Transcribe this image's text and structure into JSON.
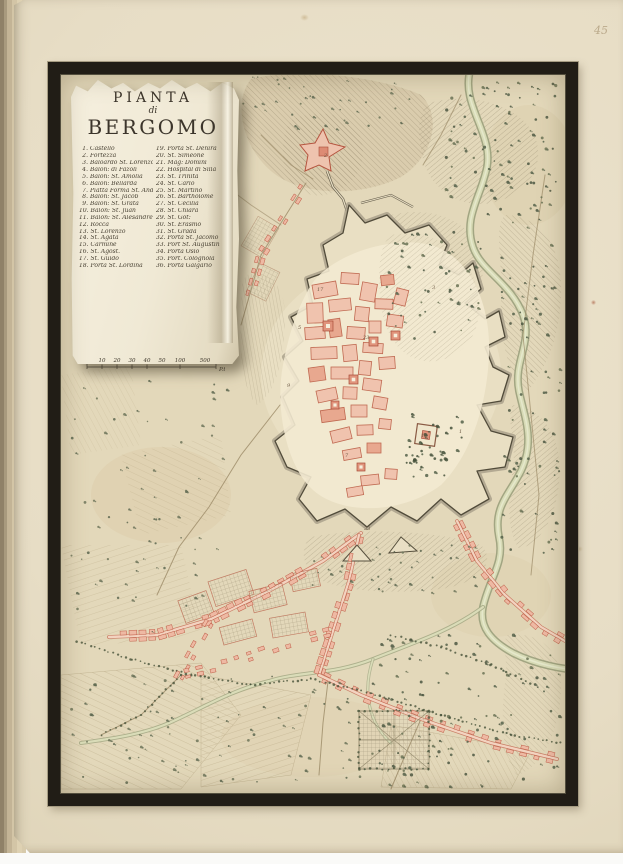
{
  "page": {
    "number": "45"
  },
  "cartouche": {
    "title_line1": "PIANTA",
    "title_line2": "di",
    "title_line3": "BERGOMO",
    "legend_col1": [
      {
        "num": "1.",
        "label": "Castello"
      },
      {
        "num": "2.",
        "label": "Fortezza"
      },
      {
        "num": "3.",
        "label": "Baloardo St. Lorenzo"
      },
      {
        "num": "4.",
        "label": "Balon: di Fazoli"
      },
      {
        "num": "5.",
        "label": "Balon: St. Amolia"
      },
      {
        "num": "6.",
        "label": "Balon: Bellarda"
      },
      {
        "num": "7.",
        "label": "Piatta Forma St. Andrea"
      },
      {
        "num": "8.",
        "label": "Balon: St. Jacob"
      },
      {
        "num": "9.",
        "label": "Balon: St. Grata"
      },
      {
        "num": "10.",
        "label": "Balon: St. Juan"
      },
      {
        "num": "11.",
        "label": "Balon: St. Alesandre"
      },
      {
        "num": "12.",
        "label": "Rocca"
      },
      {
        "num": "13.",
        "label": "St. Lorenzo"
      },
      {
        "num": "14.",
        "label": "St. Agata"
      },
      {
        "num": "15.",
        "label": "Carmine"
      },
      {
        "num": "16.",
        "label": "St. Agost."
      },
      {
        "num": "17.",
        "label": "St. Guido"
      },
      {
        "num": "18.",
        "label": "Porta St. Lordina"
      }
    ],
    "legend_col2": [
      {
        "num": "19.",
        "label": "Porta St. Denira"
      },
      {
        "num": "20.",
        "label": "St. Simeone"
      },
      {
        "num": "21.",
        "label": "Mag: Domini"
      },
      {
        "num": "22.",
        "label": "Hospital di Silla"
      },
      {
        "num": "23.",
        "label": "St. Trinita"
      },
      {
        "num": "24.",
        "label": "St. Carlo"
      },
      {
        "num": "25.",
        "label": "St. Martino"
      },
      {
        "num": "26.",
        "label": "St. Bartholome"
      },
      {
        "num": "27.",
        "label": "St. Cecilia"
      },
      {
        "num": "28.",
        "label": "St. Chiara"
      },
      {
        "num": "29.",
        "label": "St. Got:"
      },
      {
        "num": "30.",
        "label": "St. Erasmo"
      },
      {
        "num": "31.",
        "label": "St. Grada"
      },
      {
        "num": "32.",
        "label": "Porta St. Jacomo"
      },
      {
        "num": "33.",
        "label": "Port St. Augustin"
      },
      {
        "num": "34.",
        "label": "Porta Osio"
      },
      {
        "num": "35.",
        "label": "Port. Colognola"
      },
      {
        "num": "36.",
        "label": "Porta Galgario"
      }
    ],
    "scale": {
      "ticks": [
        {
          "v": "10"
        },
        {
          "v": "20"
        },
        {
          "v": "30"
        },
        {
          "v": "40"
        },
        {
          "v": "50"
        }
      ],
      "mid": "100",
      "end": "500",
      "unit": "P.ti Rg. B."
    }
  },
  "map": {
    "numbers": [
      {
        "n": "1",
        "x": 398,
        "y": 358
      },
      {
        "n": "2",
        "x": 263,
        "y": 82
      },
      {
        "n": "3",
        "x": 371,
        "y": 214
      },
      {
        "n": "5",
        "x": 237,
        "y": 254
      },
      {
        "n": "7",
        "x": 284,
        "y": 382
      },
      {
        "n": "9",
        "x": 226,
        "y": 312
      },
      {
        "n": "12",
        "x": 360,
        "y": 362
      },
      {
        "n": "17",
        "x": 256,
        "y": 216
      },
      {
        "n": "23",
        "x": 302,
        "y": 264
      },
      {
        "n": "33",
        "x": 303,
        "y": 455
      }
    ]
  },
  "colors": {
    "page_paper": "#e7ddc5",
    "map_paper": "#e3d8ba",
    "mat_black": "#211d16",
    "city_pink": "#efc2ad",
    "city_red": "#c06a52",
    "hill_hatch": "#8d8166",
    "river_green": "#aeb289",
    "tree_green": "#55614a",
    "ink": "#3c352b"
  }
}
